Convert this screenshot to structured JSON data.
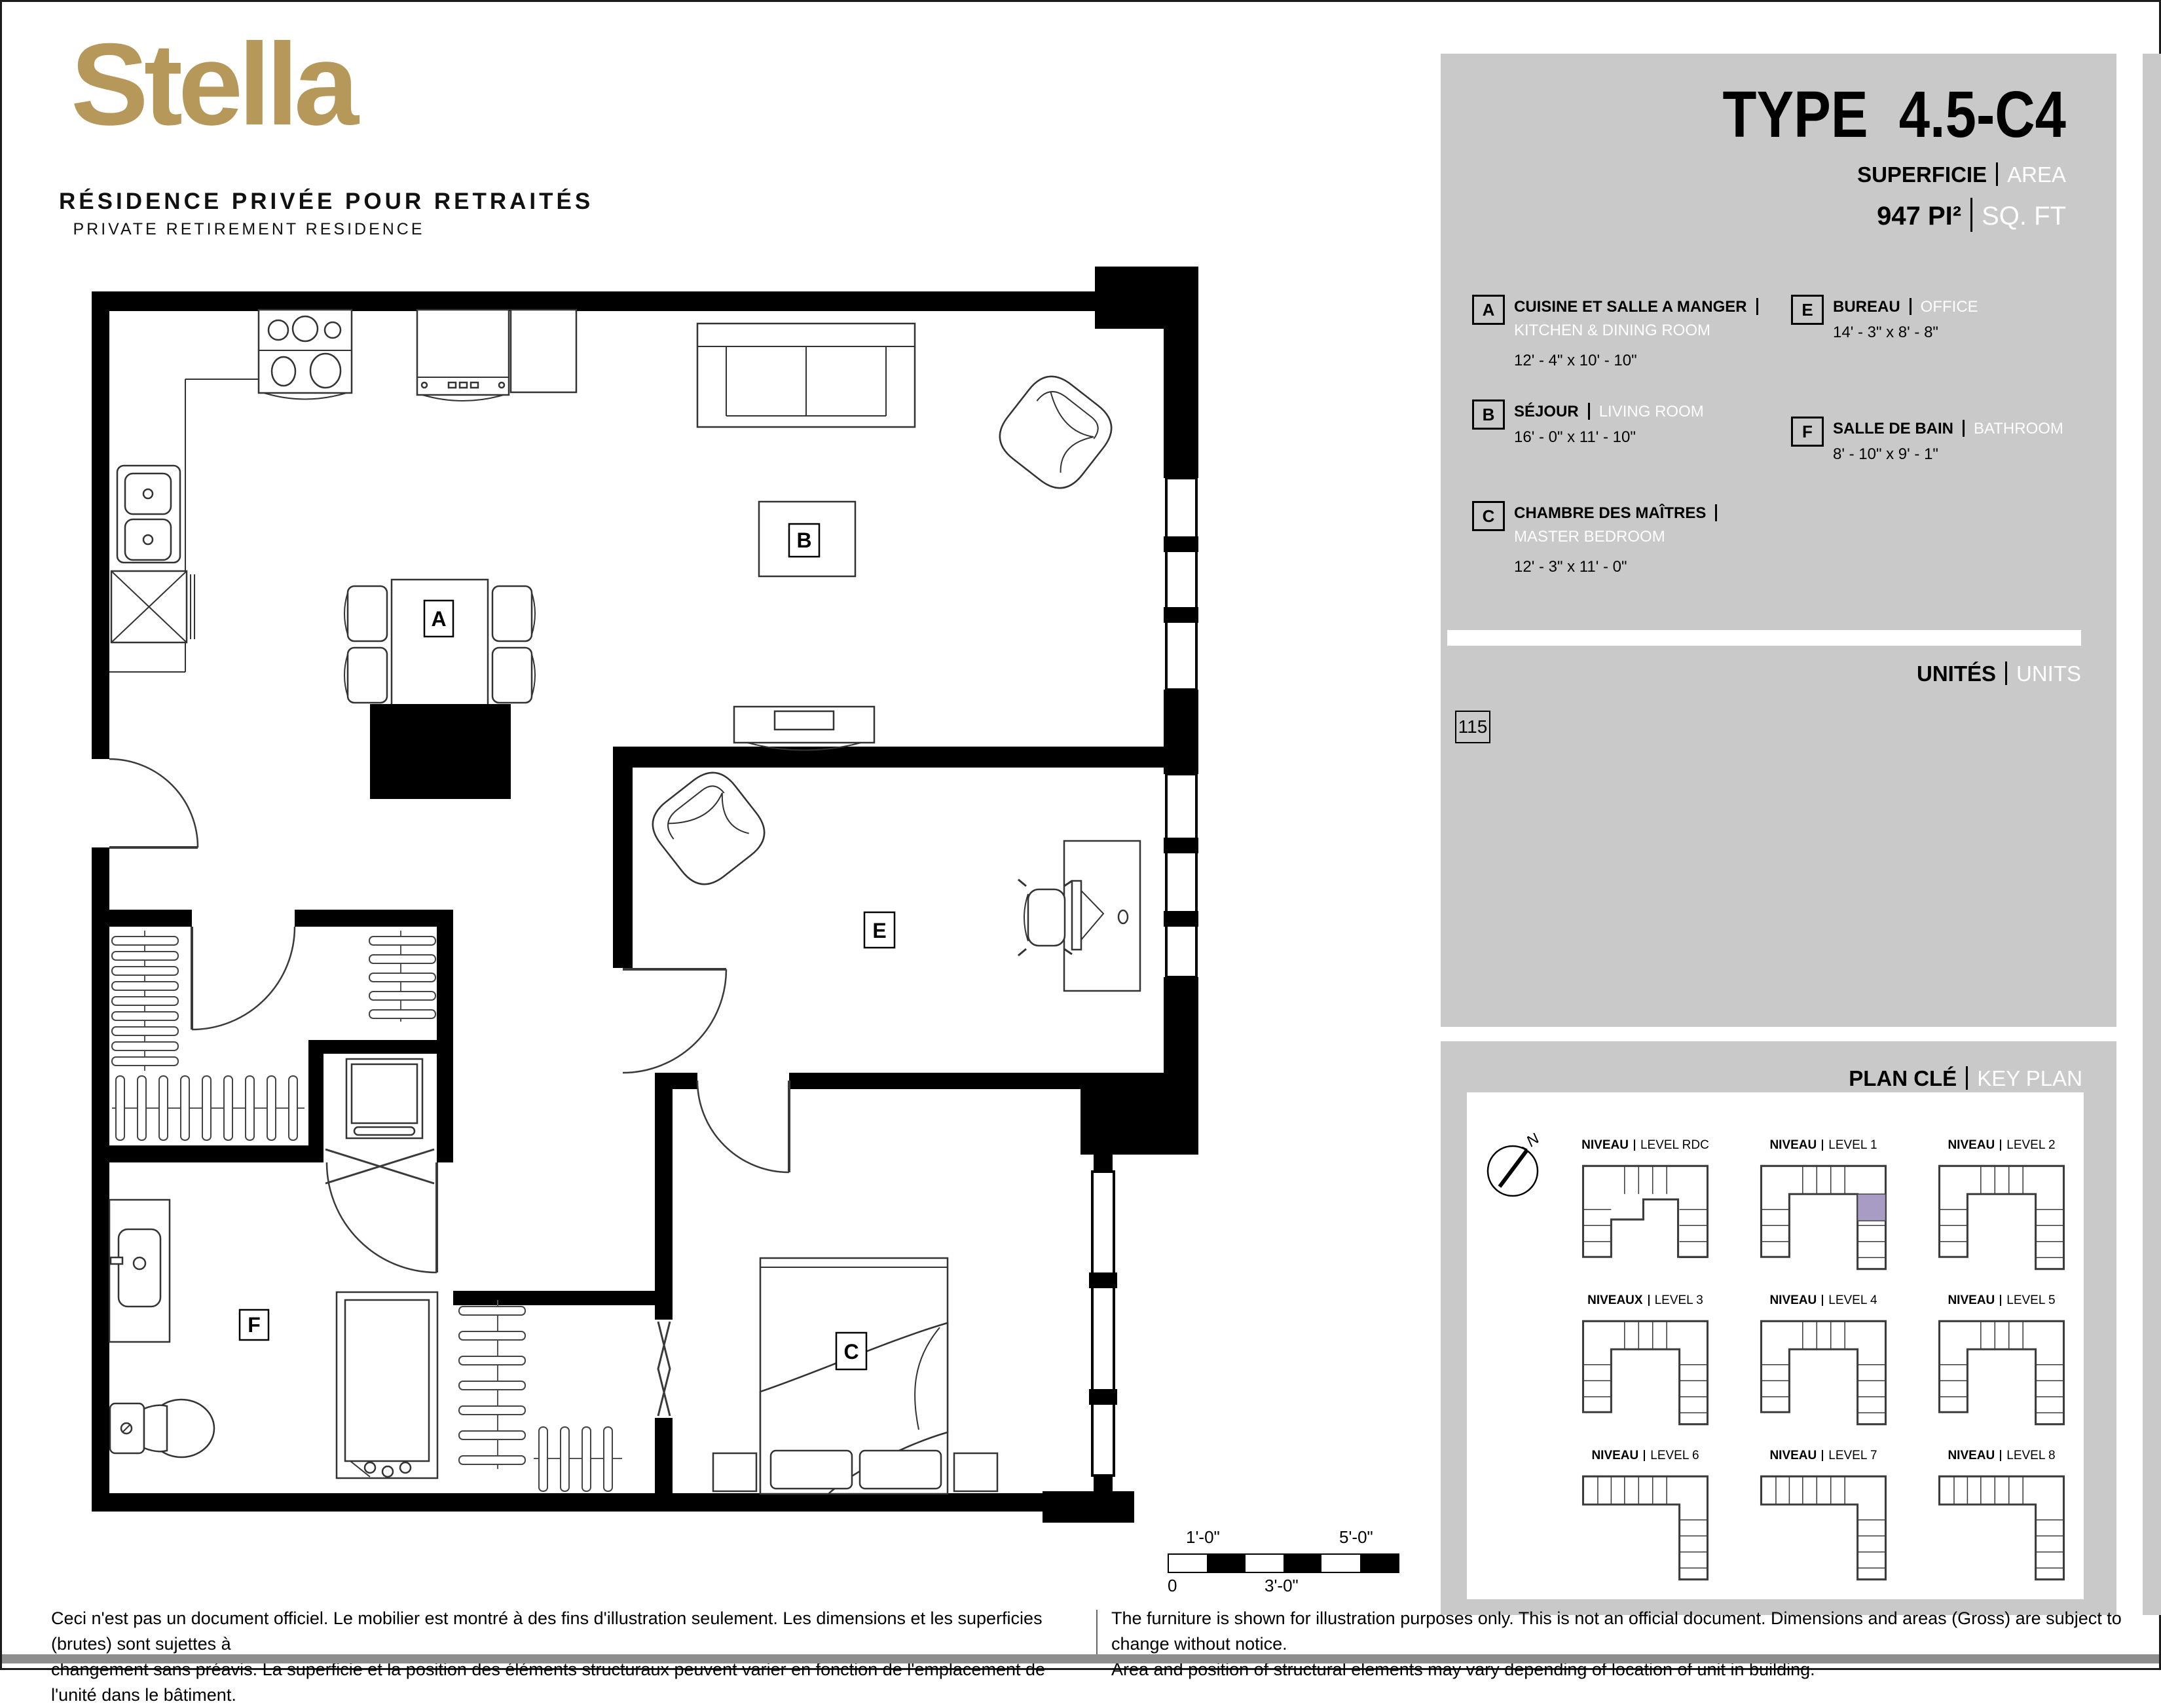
{
  "brand": {
    "name": "Stella",
    "tagline_fr": "RÉSIDENCE PRIVÉE POUR RETRAITÉS",
    "tagline_en": "PRIVATE RETIREMENT RESIDENCE",
    "gold": "#b6985a"
  },
  "header": {
    "type_label": "TYPE",
    "type_value": "4.5-C4",
    "area_label_fr": "SUPERFICIE",
    "area_label_en": "AREA",
    "area_value": "947",
    "area_unit_fr": "PI²",
    "area_unit_en": "SQ. FT"
  },
  "legend": {
    "items": [
      {
        "letter": "A",
        "name_fr": "CUISINE ET SALLE A MANGER",
        "name_en": "KITCHEN & DINING ROOM",
        "dims": "12' - 4\" x 10' - 10\""
      },
      {
        "letter": "B",
        "name_fr": "SÉJOUR",
        "name_en": "LIVING ROOM",
        "dims": "16' - 0\" x 11' - 10\""
      },
      {
        "letter": "C",
        "name_fr": "CHAMBRE DES MAÎTRES",
        "name_en": "MASTER BEDROOM",
        "dims": "12' - 3\" x 11' - 0\""
      },
      {
        "letter": "E",
        "name_fr": "BUREAU",
        "name_en": "OFFICE",
        "dims": "14' - 3\" x 8' - 8\""
      },
      {
        "letter": "F",
        "name_fr": "SALLE DE BAIN",
        "name_en": "BATHROOM",
        "dims": "8' - 10\" x 9' - 1\""
      }
    ]
  },
  "units": {
    "label_fr": "UNITÉS",
    "label_en": "UNITS",
    "numbers": [
      "115"
    ]
  },
  "keyplan": {
    "title_fr": "PLAN CLÉ",
    "title_en": "KEY PLAN",
    "north_label": "N",
    "highlight_color": "#a89cc4",
    "levels": [
      {
        "label_fr": "NIVEAU",
        "label_en": "LEVEL RDC",
        "shape": "rdc",
        "highlighted": false
      },
      {
        "label_fr": "NIVEAU",
        "label_en": "LEVEL 1",
        "shape": "u",
        "highlighted": true
      },
      {
        "label_fr": "NIVEAU",
        "label_en": "LEVEL 2",
        "shape": "u",
        "highlighted": false
      },
      {
        "label_fr": "NIVEAUX",
        "label_en": "LEVEL 3",
        "shape": "u",
        "highlighted": false
      },
      {
        "label_fr": "NIVEAU",
        "label_en": "LEVEL 4",
        "shape": "u",
        "highlighted": false
      },
      {
        "label_fr": "NIVEAU",
        "label_en": "LEVEL 5",
        "shape": "u",
        "highlighted": false
      },
      {
        "label_fr": "NIVEAU",
        "label_en": "LEVEL 6",
        "shape": "l",
        "highlighted": false
      },
      {
        "label_fr": "NIVEAU",
        "label_en": "LEVEL 7",
        "shape": "l",
        "highlighted": false
      },
      {
        "label_fr": "NIVEAU",
        "label_en": "LEVEL 8",
        "shape": "l",
        "highlighted": false
      }
    ]
  },
  "plan": {
    "labels": {
      "A": "A",
      "B": "B",
      "C": "C",
      "E": "E",
      "F": "F"
    }
  },
  "scalebar": {
    "above_left": "1'-0\"",
    "above_right": "5'-0\"",
    "below_left": "0",
    "below_mid": "3'-0\""
  },
  "footer": {
    "fr_line1": "Ceci n'est pas un document officiel.  Le mobilier est montré à des fins d'illustration seulement.  Les dimensions et les superficies (brutes) sont sujettes à",
    "fr_line2": "changement sans préavis. La superficie et la position des éléments structuraux peuvent varier en fonction de l'emplacement de l'unité dans le bâtiment.",
    "en_line1": "The furniture is shown for illustration purposes only.  This is not an official document.  Dimensions and areas (Gross) are subject to change without notice.",
    "en_line2": "Area and position of structural elements may vary depending of location of unit in building."
  },
  "colors": {
    "panel_gray": "#c9c9c9",
    "gold": "#b6985a",
    "highlight": "#a89cc4"
  }
}
